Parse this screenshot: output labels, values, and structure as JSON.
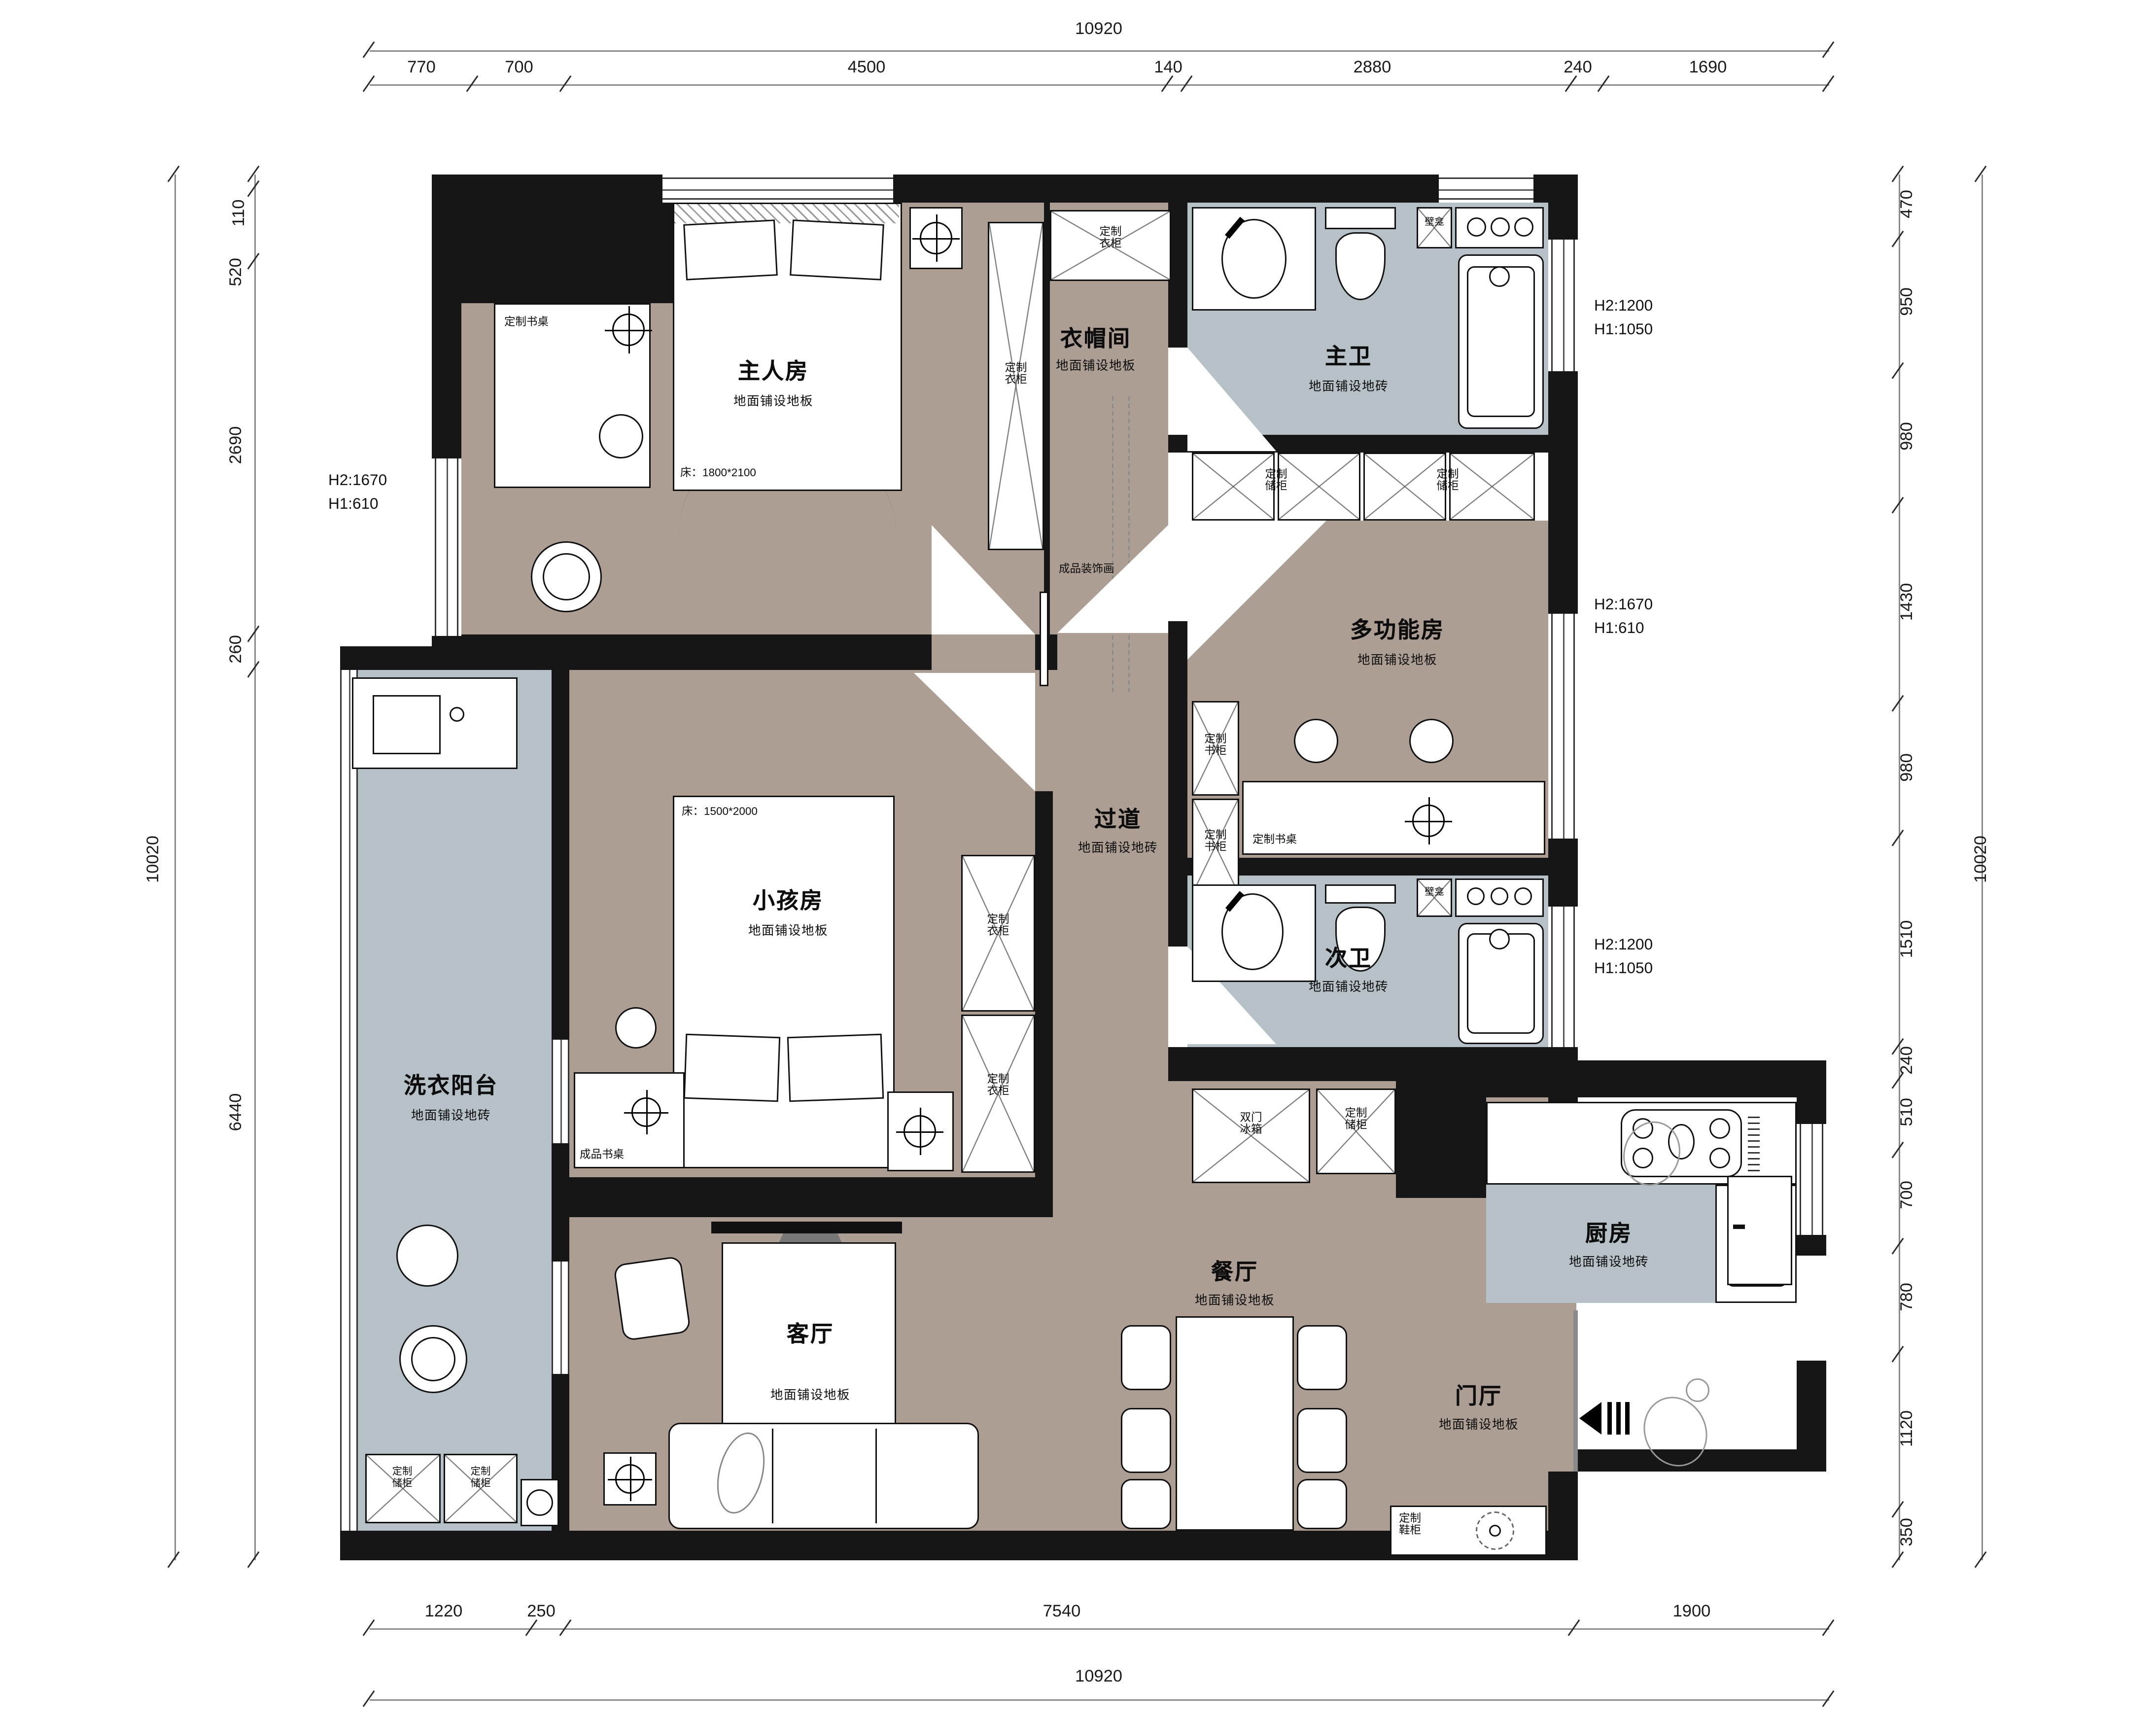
{
  "colors": {
    "wood": "#ac9e93",
    "tile": "#b5c1c6",
    "wall": "#161616"
  },
  "dims": {
    "top": {
      "overall": "10920",
      "segments": [
        "770",
        "700",
        "4500",
        "140",
        "2880",
        "240",
        "1690"
      ]
    },
    "bottom": {
      "overall": "10920",
      "segments": [
        "1220",
        "250",
        "7540",
        "1900"
      ]
    },
    "left": {
      "overall": "10020",
      "segments": [
        "110",
        "520",
        "2690",
        "260",
        "6440"
      ]
    },
    "right": {
      "overall": "10020",
      "segments": [
        "470",
        "950",
        "980",
        "1430",
        "980",
        "1510",
        "240",
        "510",
        "700",
        "780",
        "1120",
        "350"
      ]
    }
  },
  "notes": {
    "left": {
      "l1": "H2:1670",
      "l2": "H1:610"
    },
    "right_top": {
      "l1": "H2:1200",
      "l2": "H1:1050"
    },
    "right_mid": {
      "l1": "H2:1670",
      "l2": "H1:610"
    },
    "right_low": {
      "l1": "H2:1200",
      "l2": "H1:1050"
    }
  },
  "rooms": {
    "master": {
      "name": "主人房",
      "floor": "地面铺设地板"
    },
    "cloak": {
      "name": "衣帽间",
      "floor": "地面铺设地板"
    },
    "master_bath": {
      "name": "主卫",
      "floor": "地面铺设地砖"
    },
    "multi": {
      "name": "多功能房",
      "floor": "地面铺设地板"
    },
    "corridor": {
      "name": "过道",
      "floor": "地面铺设地砖"
    },
    "kids": {
      "name": "小孩房",
      "floor": "地面铺设地板"
    },
    "second_bath": {
      "name": "次卫",
      "floor": "地面铺设地砖"
    },
    "laundry": {
      "name": "洗衣阳台",
      "floor": "地面铺设地砖"
    },
    "living": {
      "name": "客厅",
      "floor": "地面铺设地板"
    },
    "dining": {
      "name": "餐厅",
      "floor": "地面铺设地板"
    },
    "kitchen": {
      "name": "厨房",
      "floor": "地面铺设地砖"
    },
    "entry": {
      "name": "门厅",
      "floor": "地面铺设地板"
    }
  },
  "labels": {
    "wardrobe": "定制\n衣柜",
    "storage": "定制\n储柜",
    "bookcase": "定制\n书柜",
    "fridge": "双门\n冰箱",
    "shoe": "定制\n鞋柜",
    "desk_custom": "定制书桌",
    "desk_ready": "成品书桌",
    "painting": "成品装饰画",
    "niche": "壁龛",
    "bed_master": "床：1800*2100",
    "bed_kids": "床：1500*2000"
  }
}
